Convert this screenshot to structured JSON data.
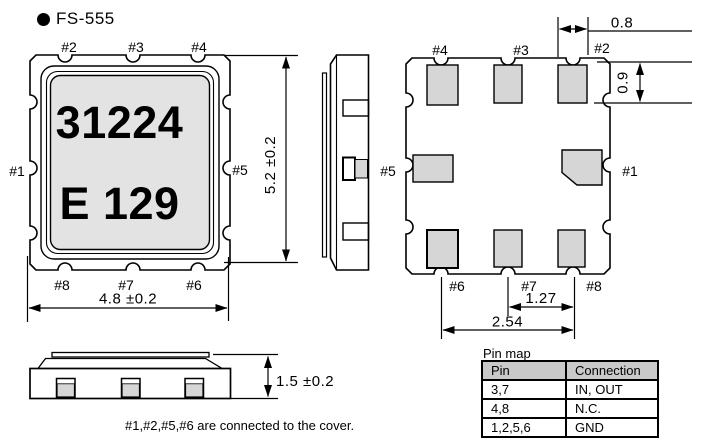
{
  "page": {
    "title": "FS-555"
  },
  "pin_labels": {
    "1": "#1",
    "2": "#2",
    "3": "#3",
    "4": "#4",
    "5": "#5",
    "6": "#6",
    "7": "#7",
    "8": "#8"
  },
  "top_view": {
    "marking_line1": "31224",
    "marking_line2": "E 129",
    "dim_width": "4.8 ±0.2",
    "dim_height": "5.2 ±0.2"
  },
  "bottom_view": {
    "dim_pad_width": "0.8",
    "dim_pad_height": "0.9",
    "dim_pitch_small": "1.27",
    "dim_pitch_large": "2.54"
  },
  "front_view": {
    "dim_height": "1.5 ±0.2"
  },
  "note": "#1,#2,#5,#6 are connected to the cover.",
  "pin_map": {
    "caption": "Pin map",
    "headers": [
      "Pin",
      "Connection"
    ],
    "rows": [
      {
        "pin": "3,7",
        "connection": "IN, OUT"
      },
      {
        "pin": "4,8",
        "connection": "N.C."
      },
      {
        "pin": "1,2,5,6",
        "connection": "GND"
      }
    ]
  },
  "colors": {
    "line": "#000000",
    "marking_bg": "#e3e3e3",
    "pad_fill": "#d6d6d6",
    "table_header_bg": "#c9c9c9"
  }
}
